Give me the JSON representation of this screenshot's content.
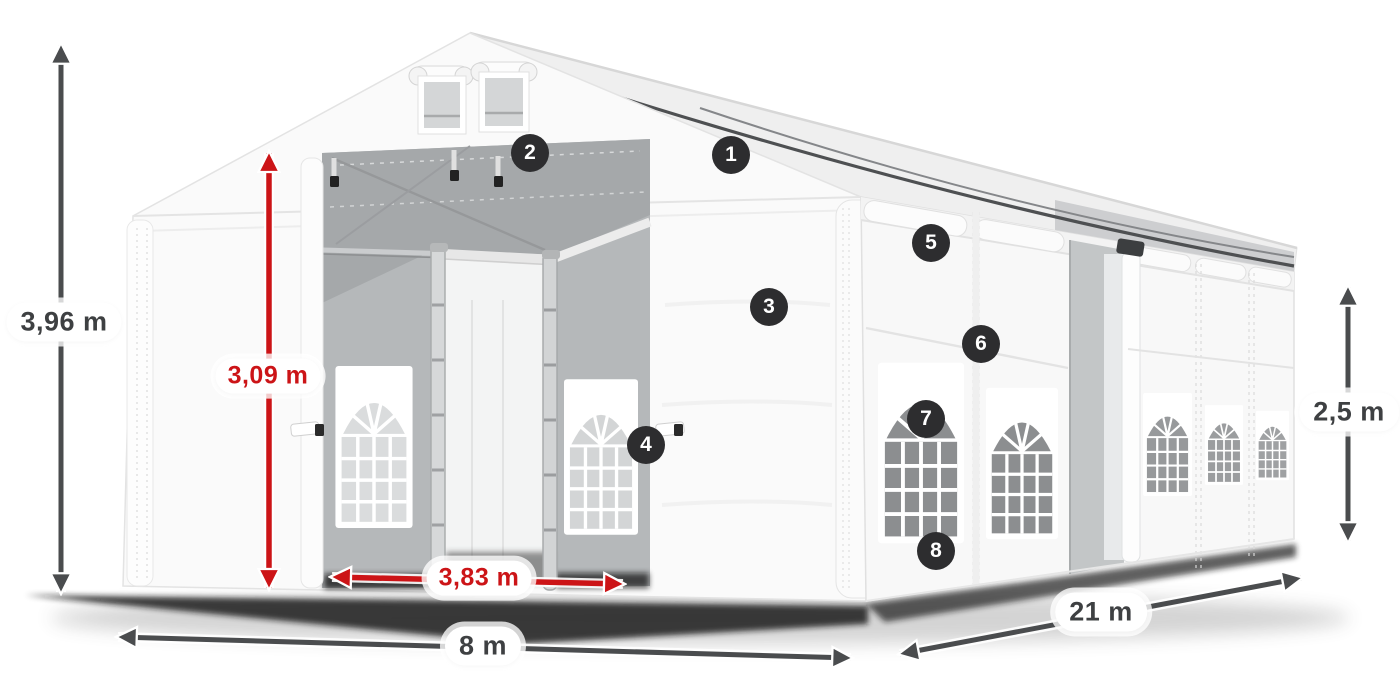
{
  "scene": {
    "title": "Party tent with dimension arrows and numbered feature callouts",
    "background": "#ffffff"
  },
  "dimensions": {
    "total_height": {
      "value": "3,96 m",
      "style": "dark"
    },
    "entrance_height": {
      "value": "3,09 m",
      "style": "red"
    },
    "entrance_width": {
      "value": "3,83 m",
      "style": "red"
    },
    "width": {
      "value": "8 m",
      "style": "dark"
    },
    "length": {
      "value": "21 m",
      "style": "dark"
    },
    "side_height": {
      "value": "2,5 m",
      "style": "dark"
    }
  },
  "callouts": [
    {
      "number": "1"
    },
    {
      "number": "2"
    },
    {
      "number": "3"
    },
    {
      "number": "4"
    },
    {
      "number": "5"
    },
    {
      "number": "6"
    },
    {
      "number": "7"
    },
    {
      "number": "8"
    }
  ],
  "colors": {
    "dimension_dark": "#4a4c4e",
    "dimension_red": "#cc1417",
    "badge_background": "#2d2d2f",
    "badge_text": "#ffffff",
    "label_text_dark": "#3e4042",
    "label_background": "#ffffff"
  }
}
